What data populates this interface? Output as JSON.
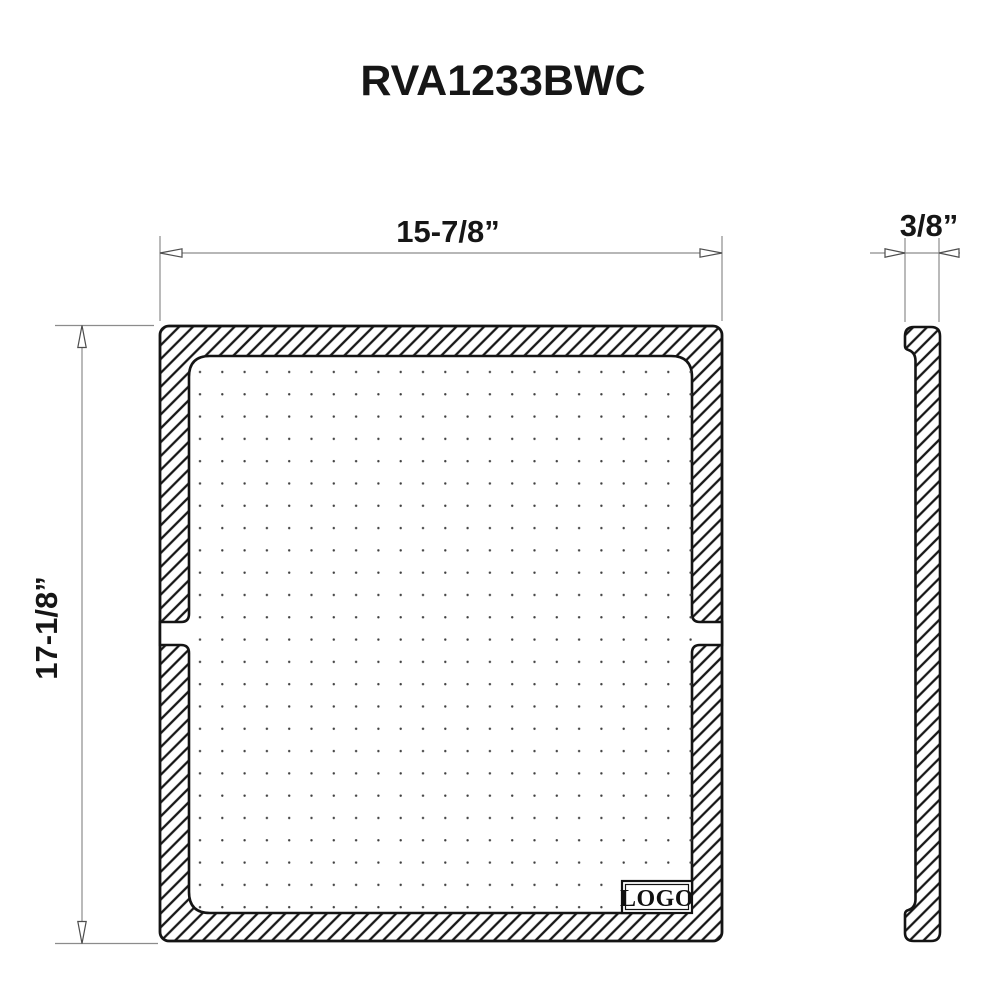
{
  "drawing": {
    "title": "RVA1233BWC",
    "logo_label": "LOGO",
    "dimensions": {
      "width_label": "15-7/8”",
      "height_label": "17-1/8”",
      "thickness_label": "3/8”"
    },
    "views": {
      "front_view": "front-view-of-panel-with-hatched-rim-and-dotted-recess",
      "side_view": "side-profile-view"
    },
    "colors": {
      "background": "#ffffff",
      "outline": "#141414",
      "hatch": "#161616",
      "dimension_line": "#8c8c8c",
      "text": "#161616",
      "dots": "#3f3f3f"
    }
  }
}
